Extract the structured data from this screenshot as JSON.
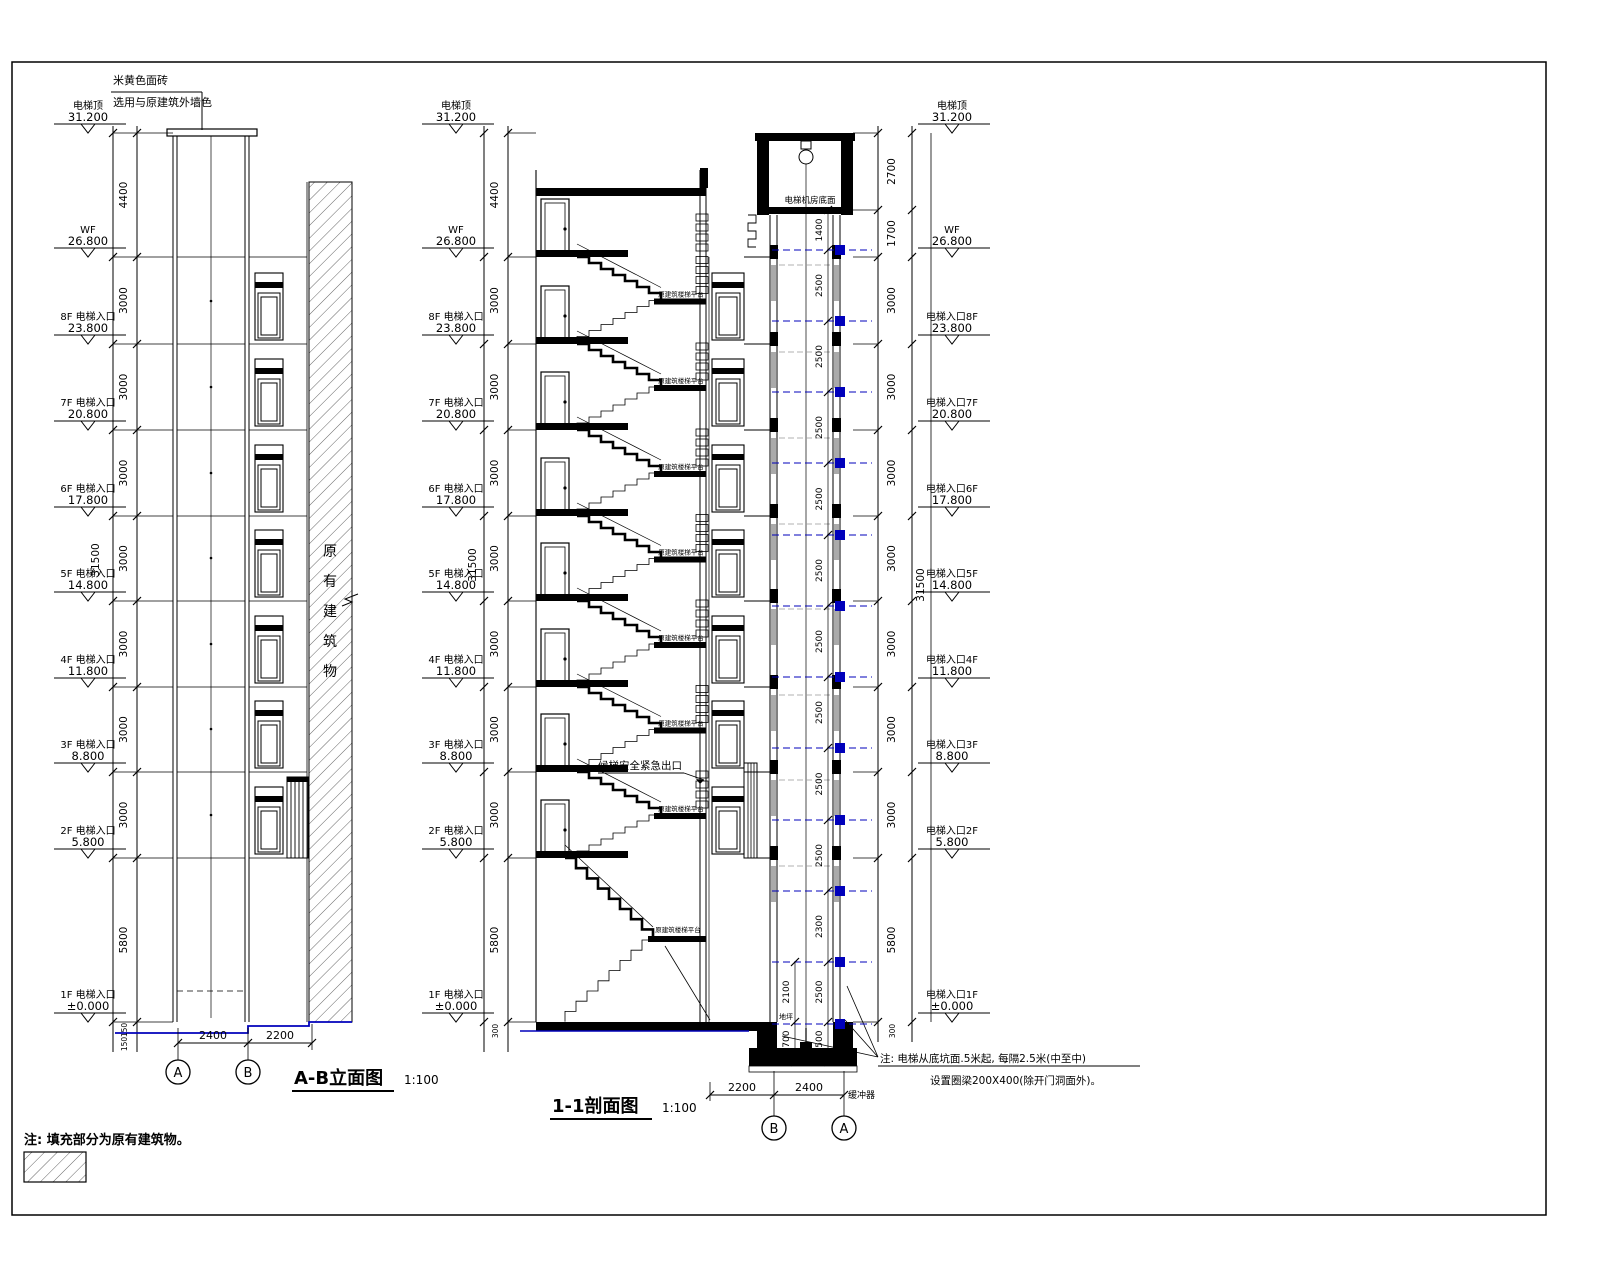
{
  "drawing": {
    "elevation": {
      "title": "A-B立面图",
      "scale": "1:100",
      "material_note_line1": "米黄色面砖",
      "material_note_line2": "选用与原建筑外墙色",
      "existing_building_label": "原有建筑物",
      "grid_bubbles": [
        "A",
        "B"
      ],
      "bottom_dims": [
        "2400",
        "2200"
      ]
    },
    "section": {
      "title": "1-1剖面图",
      "scale": "1:100",
      "machine_room_label": "电梯机房底面",
      "emergency_exit_label": "候梯安全紧急出口",
      "landing_label": "原建筑楼梯平台",
      "buffer_label": "缓冲器",
      "ground_label": "地坪",
      "grid_bubbles": [
        "B",
        "A"
      ],
      "bottom_dims": [
        "2200",
        "2400"
      ],
      "note_line1": "注: 电梯从底坑面.5米起, 每隔2.5米(中至中)",
      "note_line2": "设置圈梁200X400(除开门洞面外)。"
    },
    "legend_note": "注: 填充部分为原有建筑物。"
  },
  "levels": {
    "top": {
      "name": "电梯顶",
      "value": "31.200"
    },
    "wf": {
      "name": "WF",
      "value": "26.800"
    },
    "floors": [
      {
        "lname": "8F 电梯入口",
        "rname": "电梯入口8F",
        "value": "23.800",
        "dim": "3000"
      },
      {
        "lname": "7F 电梯入口",
        "rname": "电梯入口7F",
        "value": "20.800",
        "dim": "3000"
      },
      {
        "lname": "6F 电梯入口",
        "rname": "电梯入口6F",
        "value": "17.800",
        "dim": "3000"
      },
      {
        "lname": "5F 电梯入口",
        "rname": "电梯入口5F",
        "value": "14.800",
        "dim": "3000"
      },
      {
        "lname": "4F 电梯入口",
        "rname": "电梯入口4F",
        "value": "11.800",
        "dim": "3000"
      },
      {
        "lname": "3F 电梯入口",
        "rname": "电梯入口3F",
        "value": "8.800",
        "dim": "3000"
      },
      {
        "lname": "2F 电梯入口",
        "rname": "电梯入口2F",
        "value": "5.800",
        "dim": "3000"
      }
    ],
    "ground": {
      "lname": "1F 电梯入口",
      "rname": "电梯入口1F",
      "value": "±0.000"
    }
  },
  "dims": {
    "total": "31500",
    "top_span": "4400",
    "ground_span": "5800",
    "small_150a": "150",
    "small_150b": "150",
    "small_300": "300",
    "right_top": [
      "2700",
      "1700"
    ],
    "shaft_col": [
      "1400",
      "2500",
      "2500",
      "2500",
      "2500",
      "2500",
      "2500",
      "2500",
      "2500",
      "2500",
      "2300",
      "2500",
      "1500"
    ],
    "shaft_col_left": [
      "2100",
      "1700"
    ]
  }
}
